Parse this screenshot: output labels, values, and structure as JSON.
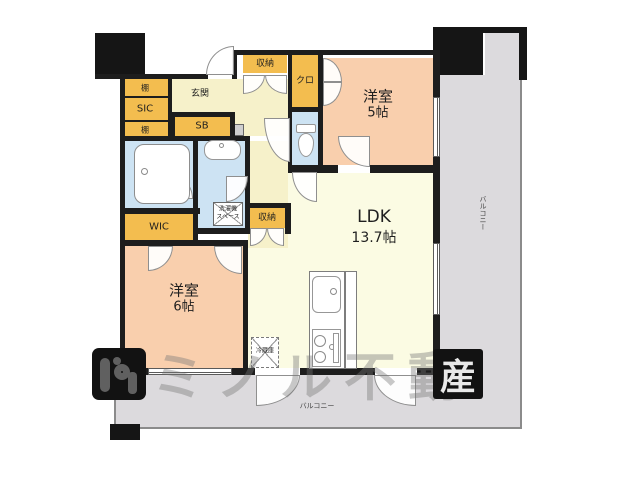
{
  "rooms": {
    "ldk": {
      "label": "LDK",
      "size": "13.7帖"
    },
    "western5": {
      "label": "洋室",
      "size": "5帖"
    },
    "western6": {
      "label": "洋室",
      "size": "6帖"
    },
    "entrance": {
      "label": "玄関"
    },
    "sic": {
      "label": "SIC"
    },
    "shelf_top": {
      "label": "棚"
    },
    "shelf_bottom": {
      "label": "棚"
    },
    "sb": {
      "label": "SB"
    },
    "storage_top": {
      "label": "収納"
    },
    "storage_mid": {
      "label": "収納"
    },
    "closet": {
      "label": "クロ"
    },
    "wic": {
      "label": "WIC"
    },
    "laundry": {
      "line1": "洗濯機",
      "line2": "スペース"
    },
    "fridge": {
      "label": "冷蔵庫"
    },
    "balcony_right": {
      "label": "バルコニー"
    },
    "balcony_bottom": {
      "label": "バルコニー"
    }
  },
  "watermark": {
    "text": "ミノル不動",
    "last_char": "産"
  },
  "colors": {
    "wall": "#1d1d1d",
    "storage_orange": "#f3bd4f",
    "room_peach": "#f9cfad",
    "hall_cream": "#f6f1ca",
    "ldk_cream": "#fbfbe3",
    "wet_blue": "#cde3f3",
    "balcony_gray": "#dcdadd"
  }
}
